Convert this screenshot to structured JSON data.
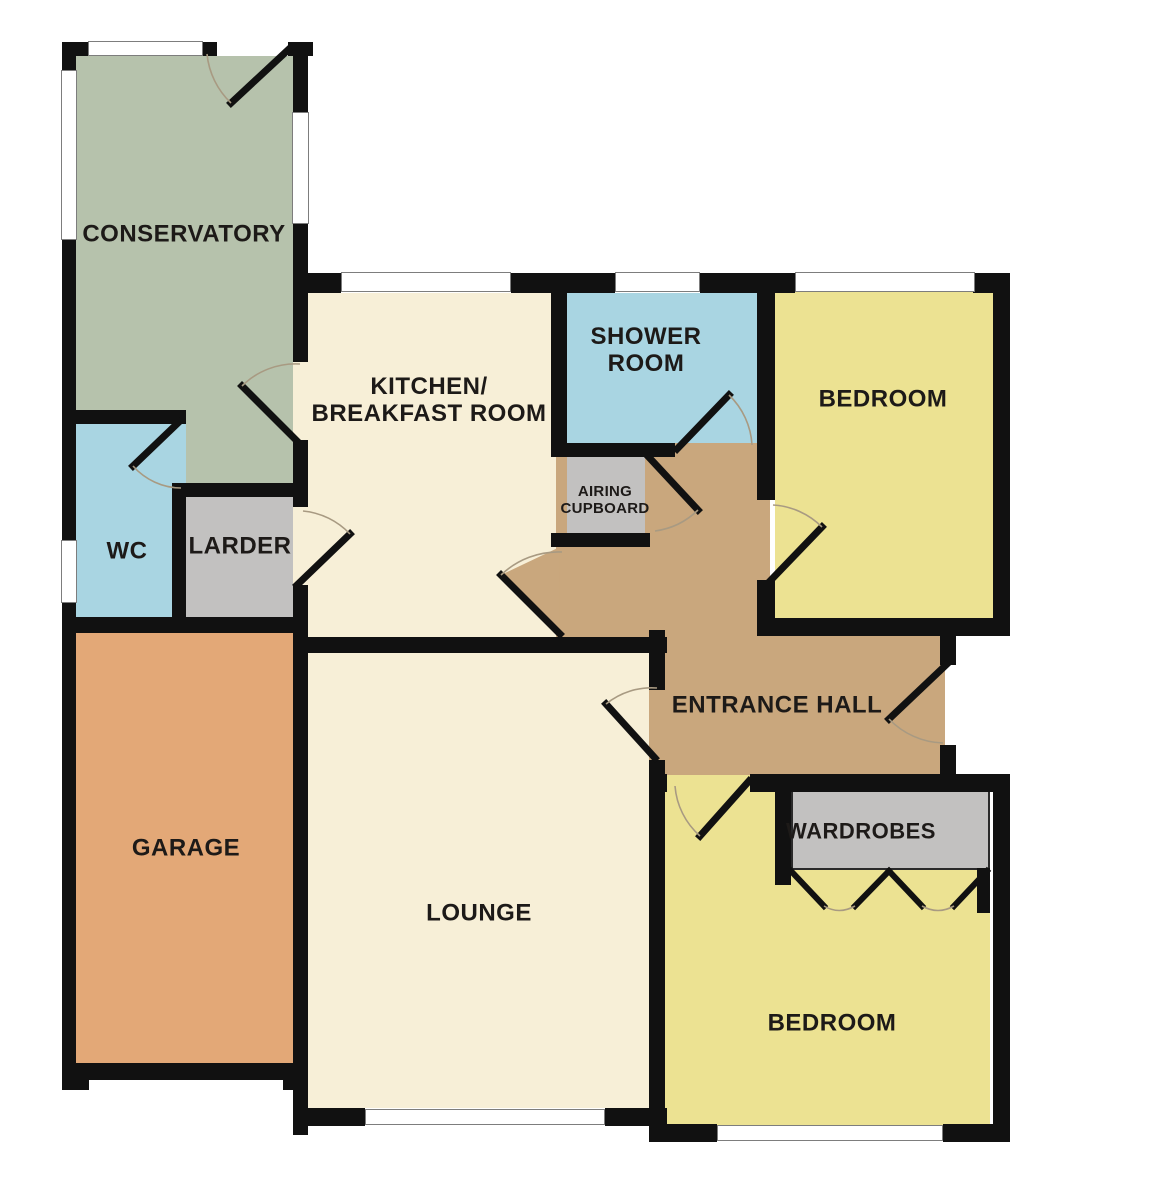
{
  "plan": {
    "title": "Bungalow floor plan",
    "rooms": {
      "conservatory": {
        "label": "CONSERVATORY"
      },
      "kitchen": {
        "label_line1": "KITCHEN/",
        "label_line2": "BREAKFAST ROOM"
      },
      "shower": {
        "label_line1": "SHOWER",
        "label_line2": "ROOM"
      },
      "bedroom_top": {
        "label": "BEDROOM"
      },
      "wc": {
        "label": "WC"
      },
      "larder": {
        "label": "LARDER"
      },
      "airing": {
        "label_line1": "AIRING",
        "label_line2": "CUPBOARD"
      },
      "entrance_hall": {
        "label": "ENTRANCE HALL"
      },
      "garage": {
        "label": "GARAGE"
      },
      "lounge": {
        "label": "LOUNGE"
      },
      "wardrobes": {
        "label": "WARDROBES"
      },
      "bedroom_bottom": {
        "label": "BEDROOM"
      }
    },
    "palette": {
      "conservatory": "#b6c2ac",
      "wet_room": "#a9d5e2",
      "storage": "#c2c1c0",
      "living": "#f7efd7",
      "bedroom": "#ece292",
      "hall": "#c9a77d",
      "garage": "#e3a877",
      "wall": "#111111",
      "window": "#ffffff"
    }
  }
}
